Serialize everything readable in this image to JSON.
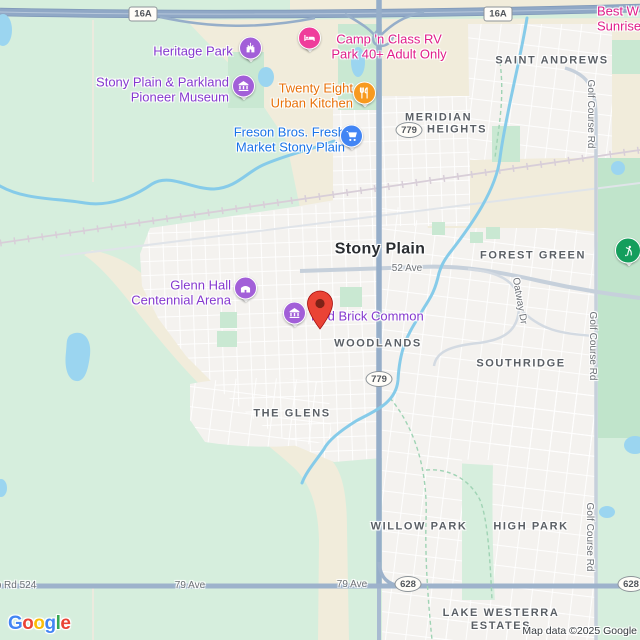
{
  "map": {
    "attribution": "Map data ©2025 Google",
    "logo_letters": [
      {
        "ch": "G",
        "color": "#4285F4"
      },
      {
        "ch": "o",
        "color": "#EA4335"
      },
      {
        "ch": "o",
        "color": "#FBBC05"
      },
      {
        "ch": "g",
        "color": "#4285F4"
      },
      {
        "ch": "l",
        "color": "#34A853"
      },
      {
        "ch": "e",
        "color": "#EA4335"
      }
    ],
    "colors": {
      "water": "#9bd5f0",
      "green": "#d6eedd",
      "cream": "#f1ecdb",
      "urban": "#f4f2ef",
      "golf_green": "#c0e4cb",
      "freeway": "#90a8c6",
      "arterial": "#9db2cb",
      "road_gray": "#c6d0db",
      "poi_purple": "#a25fd8",
      "poi_pink": "#ef3d9b",
      "poi_orange": "#f79a1f",
      "poi_blue": "#4285F4",
      "poi_green": "#149e5c",
      "pin_red": "#EA4335"
    },
    "shields": [
      {
        "text": "16A",
        "x": 143,
        "y": 14,
        "shape": "rect"
      },
      {
        "text": "16A",
        "x": 498,
        "y": 14,
        "shape": "rect"
      },
      {
        "text": "779",
        "x": 409,
        "y": 130,
        "shape": "oval"
      },
      {
        "text": "779",
        "x": 379,
        "y": 379,
        "shape": "oval"
      },
      {
        "text": "628",
        "x": 408,
        "y": 584,
        "shape": "oval"
      },
      {
        "text": "628",
        "x": 631,
        "y": 584,
        "shape": "oval"
      }
    ],
    "labels": [
      {
        "text": "Stony Plain",
        "x": 380,
        "y": 250,
        "cls": "city",
        "name": "city-label-stony-plain"
      },
      {
        "text": "SAINT ANDREWS",
        "x": 552,
        "y": 61,
        "cls": "area",
        "name": "area-label-saint-andrews"
      },
      {
        "text": "MERIDIAN",
        "x": 405,
        "y": 118,
        "cls": "area",
        "align": "left",
        "name": "area-label-meridian"
      },
      {
        "text": "HEIGHTS",
        "x": 427,
        "y": 130,
        "cls": "area",
        "align": "left",
        "name": "area-label-heights"
      },
      {
        "text": "FOREST GREEN",
        "x": 533,
        "y": 256,
        "cls": "area",
        "name": "area-label-forest-green"
      },
      {
        "text": "WOODLANDS",
        "x": 378,
        "y": 344,
        "cls": "area",
        "name": "area-label-woodlands"
      },
      {
        "text": "SOUTHRIDGE",
        "x": 521,
        "y": 364,
        "cls": "area",
        "name": "area-label-southridge"
      },
      {
        "text": "THE GLENS",
        "x": 292,
        "y": 414,
        "cls": "area",
        "name": "area-label-the-glens"
      },
      {
        "text": "WILLOW PARK",
        "x": 419,
        "y": 527,
        "cls": "area",
        "name": "area-label-willow-park"
      },
      {
        "text": "HIGH PARK",
        "x": 531,
        "y": 527,
        "cls": "area",
        "name": "area-label-high-park"
      },
      {
        "text": "LAKE WESTERRA\nESTATES",
        "x": 501,
        "y": 620,
        "cls": "area",
        "name": "area-label-lake-westerra-estates"
      },
      {
        "text": "52 Ave",
        "x": 407,
        "y": 269,
        "cls": "road",
        "name": "road-label-52-ave"
      },
      {
        "text": "79 Ave",
        "x": 190,
        "y": 586,
        "cls": "road",
        "name": "road-label-79-ave"
      },
      {
        "text": "79 Ave",
        "x": 352,
        "y": 585,
        "cls": "road",
        "name": "road-label-79-ave"
      },
      {
        "text": "p Rd 524",
        "x": 16,
        "y": 586,
        "cls": "road",
        "name": "road-label-twp-rd-524"
      },
      {
        "text": "Golf Course Rd",
        "x": 590,
        "y": 114,
        "cls": "road",
        "rot": 90,
        "name": "road-label-golf-course-rd"
      },
      {
        "text": "Golf Course Rd",
        "x": 592,
        "y": 346,
        "cls": "road",
        "rot": 90,
        "name": "road-label-golf-course-rd"
      },
      {
        "text": "Golf Course Rd",
        "x": 589,
        "y": 537,
        "cls": "road",
        "rot": 90,
        "name": "road-label-golf-course-rd"
      },
      {
        "text": "Oatway Dr",
        "x": 519,
        "y": 301,
        "cls": "road",
        "rot": 80,
        "name": "road-label-oatway-dr"
      },
      {
        "text": "Heritage Park",
        "x": 193,
        "y": 51,
        "cls": "poi-label c-purple",
        "poi": true,
        "name": "poi-label-heritage-park"
      },
      {
        "text": "Stony Plain & Parkland\nPioneer Museum",
        "x": 229,
        "y": 90,
        "cls": "poi-label c-purple",
        "align": "right",
        "poi": true,
        "name": "poi-label-pioneer-museum"
      },
      {
        "text": "Glenn Hall\nCentennial Arena",
        "x": 231,
        "y": 293,
        "cls": "poi-label c-purple",
        "align": "right",
        "poi": true,
        "name": "poi-label-glenn-hall-arena"
      },
      {
        "text": "Red Brick Common",
        "x": 311,
        "y": 316,
        "cls": "poi-label c-purple",
        "align": "left",
        "poi": true,
        "name": "poi-label-red-brick-common"
      },
      {
        "text": "Camp 'n Class RV\nPark 40+ Adult Only",
        "x": 389,
        "y": 47,
        "cls": "poi-label c-pink",
        "poi": true,
        "name": "poi-label-camp-n-class-rv-park"
      },
      {
        "text": "Best W\nSunrise Inn &",
        "x": 597,
        "y": 19,
        "cls": "poi-label c-pink",
        "align": "left",
        "poi": true,
        "name": "poi-label-best-western-sunrise-inn"
      },
      {
        "text": "Twenty Eight\nUrban Kitchen",
        "x": 353,
        "y": 96,
        "cls": "poi-label c-orange",
        "align": "right",
        "poi": true,
        "name": "poi-label-twenty-eight-urban-kitchen"
      },
      {
        "text": "Freson Bros. Fresh\nMarket Stony Plain",
        "x": 345,
        "y": 140,
        "cls": "poi-label c-blue",
        "align": "right",
        "poi": true,
        "name": "poi-label-freson-bros-market"
      }
    ],
    "pois": [
      {
        "glyph": "attraction",
        "color": "#a25fd8",
        "x": 251,
        "y": 50,
        "name": "heritage-park-icon"
      },
      {
        "glyph": "lodging",
        "color": "#ef3d9b",
        "x": 310,
        "y": 40,
        "name": "rv-park-lodging-icon"
      },
      {
        "glyph": "museum",
        "color": "#a25fd8",
        "x": 244,
        "y": 88,
        "name": "pioneer-museum-icon"
      },
      {
        "glyph": "restaurant",
        "color": "#f79a1f",
        "x": 365,
        "y": 95,
        "name": "restaurant-icon"
      },
      {
        "glyph": "grocery",
        "color": "#4285F4",
        "x": 352,
        "y": 138,
        "name": "grocery-store-icon"
      },
      {
        "glyph": "arena",
        "color": "#a25fd8",
        "x": 246,
        "y": 290,
        "name": "arena-icon"
      },
      {
        "glyph": "museum",
        "color": "#a25fd8",
        "x": 295,
        "y": 315,
        "name": "red-brick-common-icon"
      },
      {
        "glyph": "golf",
        "color": "#149e5c",
        "x": 629,
        "y": 251,
        "big": true,
        "name": "golf-course-icon"
      }
    ],
    "pin": {
      "x": 320,
      "y": 330,
      "name": "destination-pin"
    }
  }
}
